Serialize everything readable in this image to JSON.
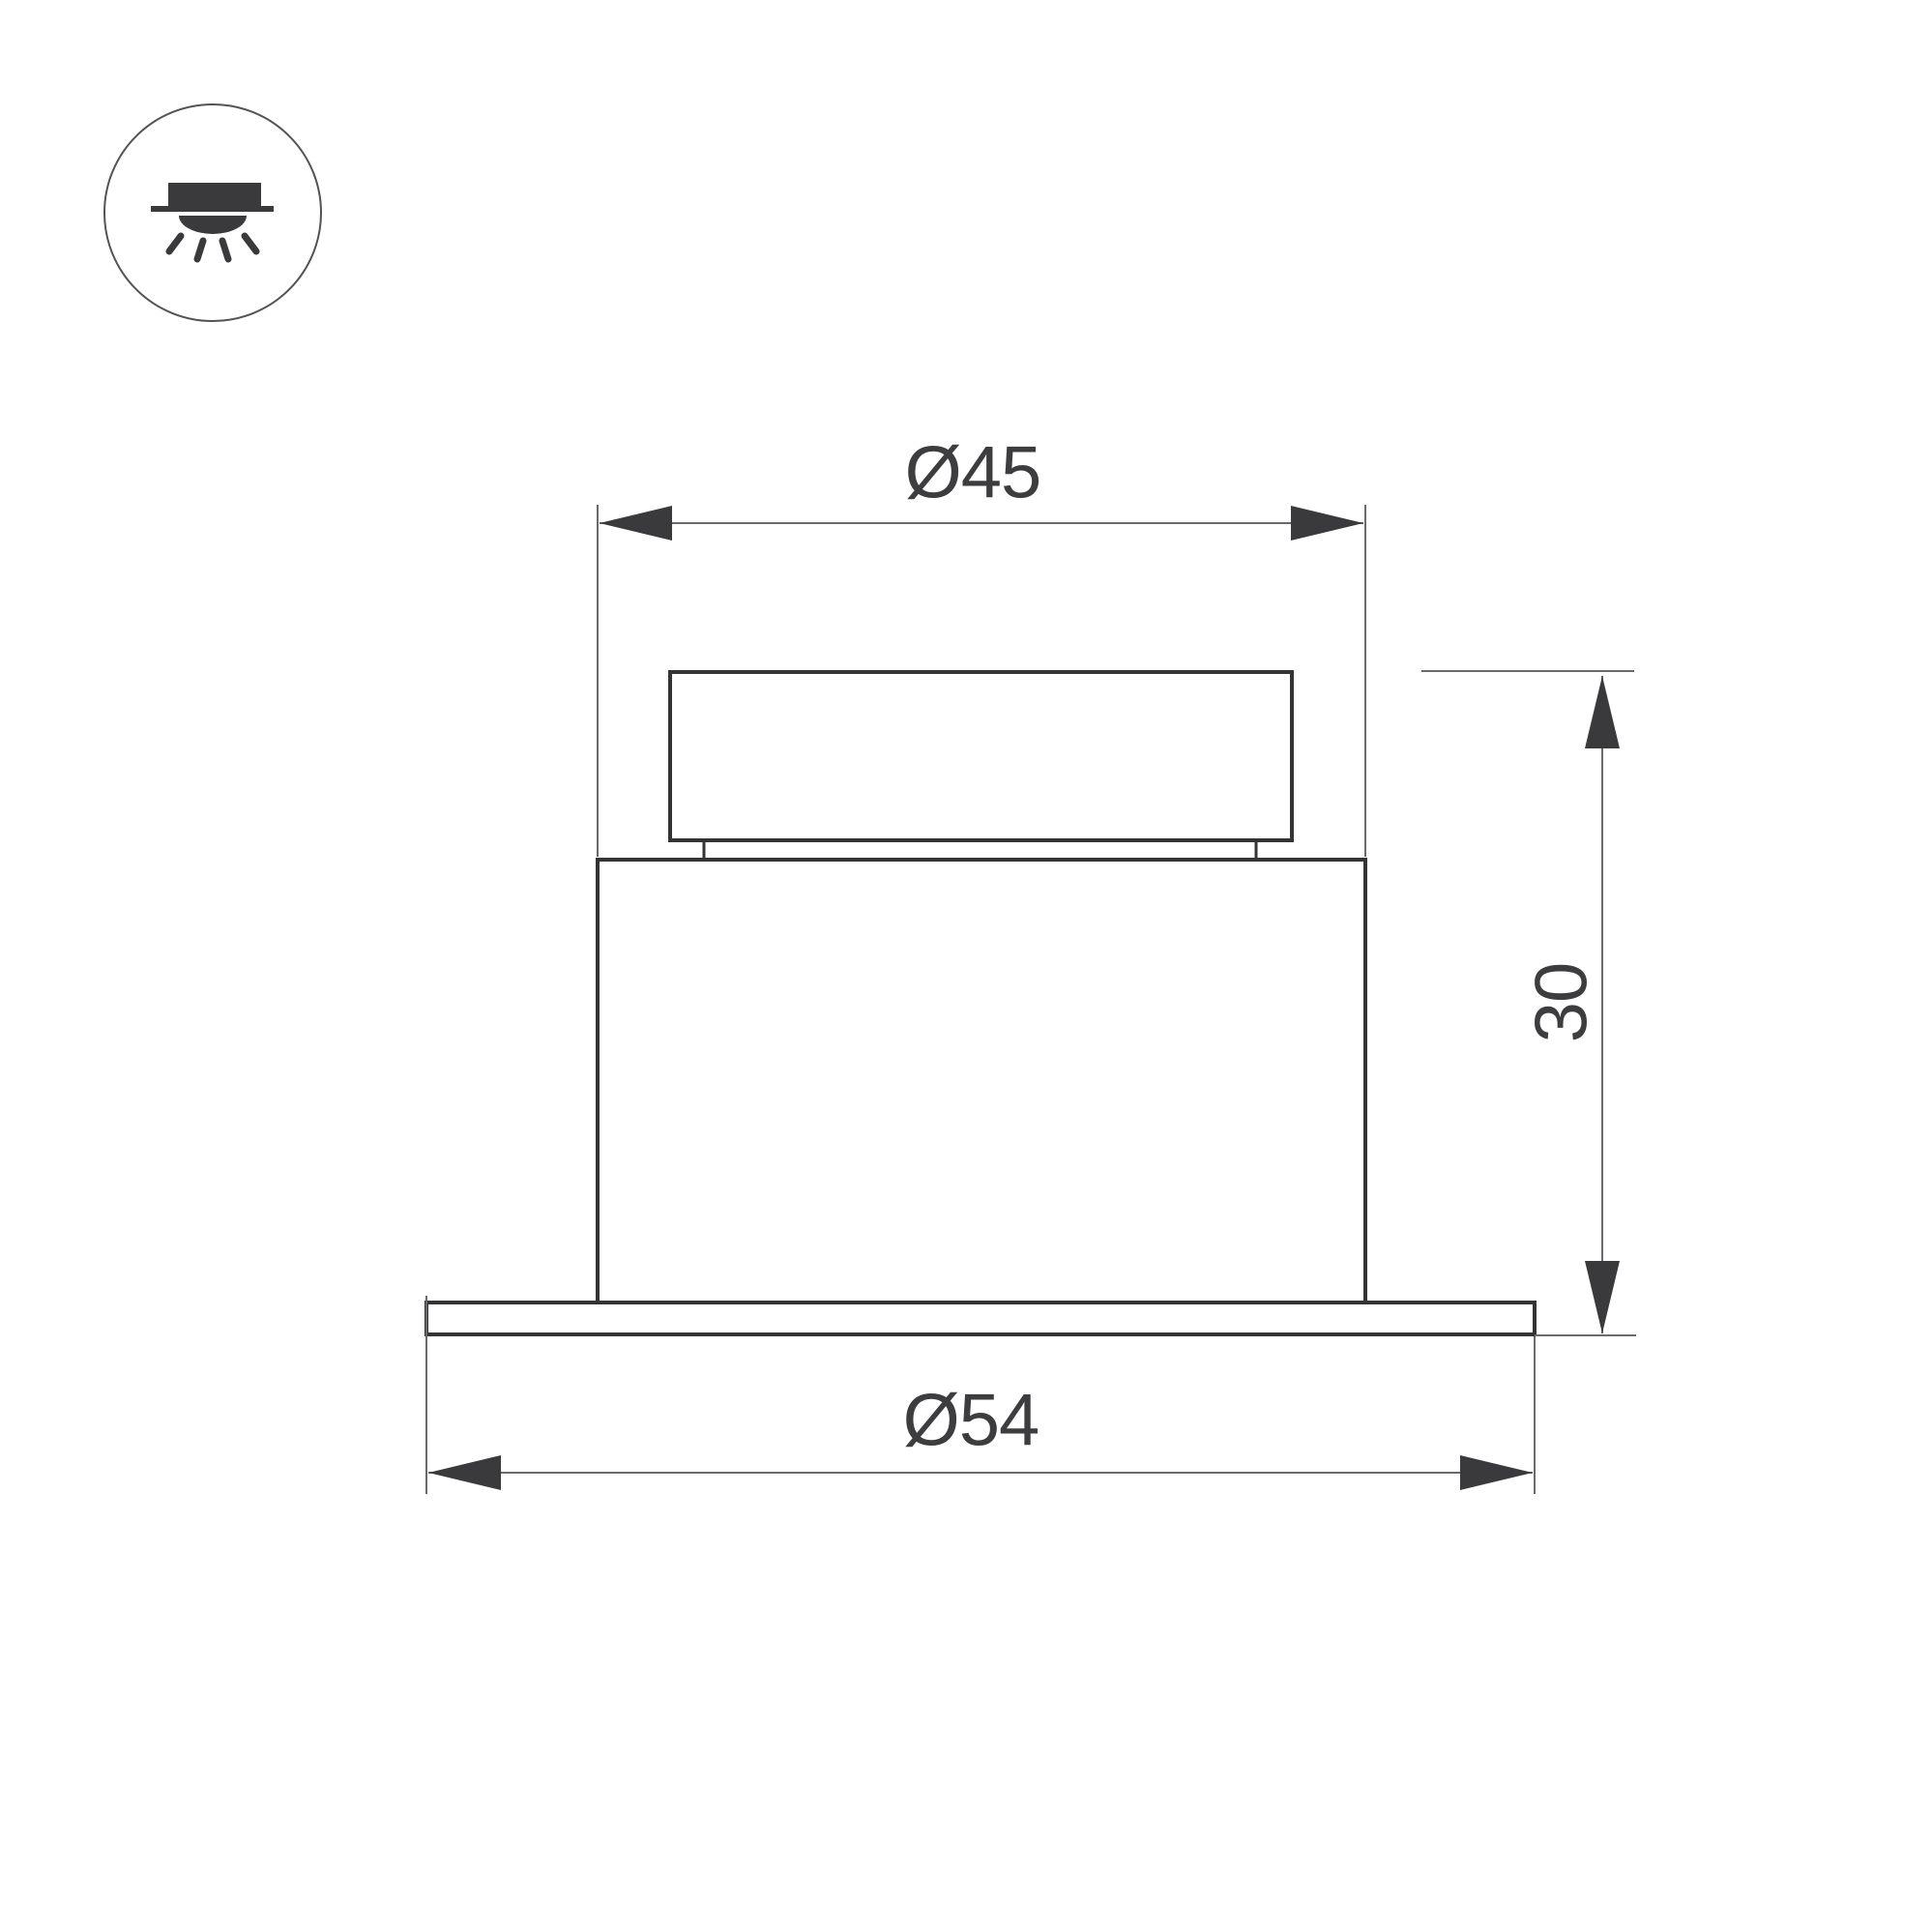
{
  "page": {
    "background_color": "#ffffff"
  },
  "type_icon": {
    "meaning": "recessed-downlight",
    "circle_color": "#535355",
    "glyph_color": "#3a3a3c"
  },
  "drawing": {
    "outline_color": "#343437",
    "dimension_line_color": "#6a6a6c",
    "label_color": "#3d3d3f",
    "dimensions": {
      "body_diameter": {
        "label": "Ø45",
        "value": 45
      },
      "flange_diameter": {
        "label": "Ø54",
        "value": 54
      },
      "height": {
        "label": "30",
        "value": 30
      }
    }
  }
}
